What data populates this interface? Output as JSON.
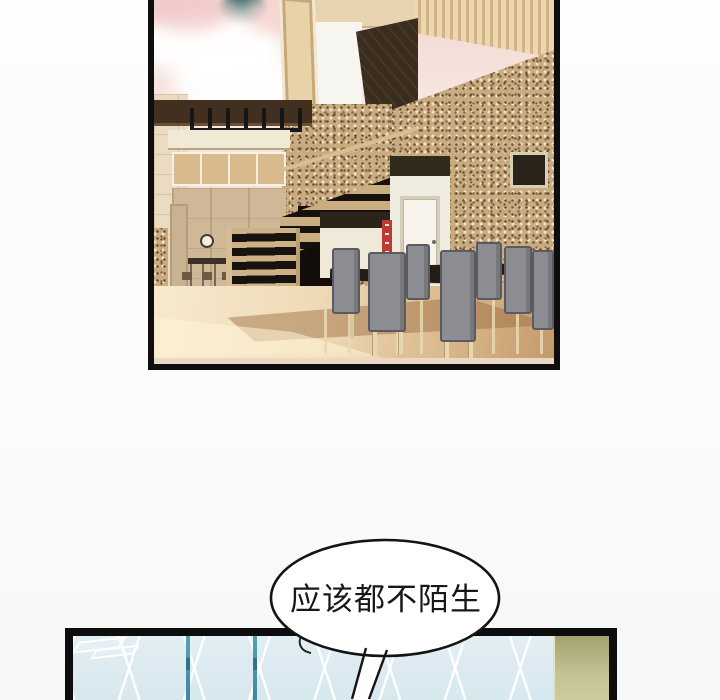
{
  "speech_bubble": {
    "text": "应该都不陌生",
    "fill": "#ffffff",
    "stroke": "#141414"
  },
  "palette": {
    "page_background": "#fbfbfb",
    "panel_border": "#0d0d0d",
    "sky_pink": "#f2d8d3",
    "sky_teal_glimpse": "#2b6663",
    "mosaic_base": "#c9ab80",
    "mosaic_dark": "#6e5136",
    "mosaic_light": "#f0e2c2",
    "beam_brown": "#41301f",
    "floor_light": "#f7ead0",
    "floor_dark": "#c49a6c",
    "stair_tread": "#17120d",
    "stair_wood": "#ccb286",
    "chair_gray": "#8c8d92",
    "table_dark": "#241d16",
    "door_white": "#f6f4ea",
    "sign_red": "#bf3a31",
    "tile_blue": "#d7e8ef",
    "tile_grid_white": "#ffffff",
    "rail_teal": "#4d95aa",
    "wall_olive": "#b8b886"
  }
}
